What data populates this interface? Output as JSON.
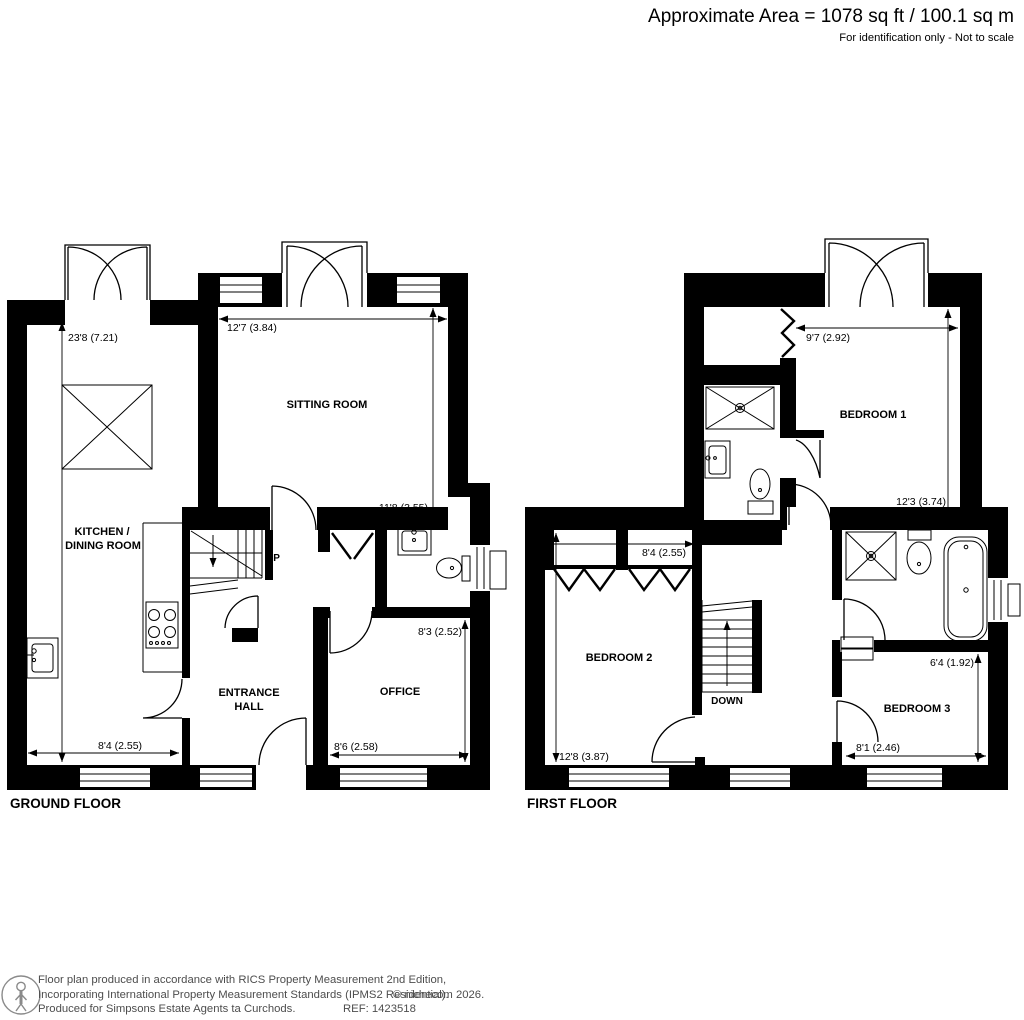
{
  "header": {
    "area_line": "Approximate Area = 1078 sq ft / 100.1 sq m",
    "note_line": "For identification only - Not to scale"
  },
  "ground_floor": {
    "label": "GROUND FLOOR",
    "rooms": {
      "sitting_room": "SITTING ROOM",
      "kitchen_line1": "KITCHEN /",
      "kitchen_line2": "DINING ROOM",
      "hall_line1": "ENTRANCE",
      "hall_line2": "HALL",
      "office": "OFFICE"
    },
    "stairs_label": "UP",
    "dims": {
      "kitchen_length": "23'8 (7.21)",
      "sitting_width": "12'7 (3.84)",
      "sitting_depth": "11'8 (3.55)",
      "kitchen_width": "8'4 (2.55)",
      "office_width": "8'6 (2.58)",
      "office_depth": "8'3 (2.52)"
    }
  },
  "first_floor": {
    "label": "FIRST FLOOR",
    "rooms": {
      "bedroom1": "BEDROOM 1",
      "bedroom2": "BEDROOM 2",
      "bedroom3": "BEDROOM 3"
    },
    "stairs_label": "DOWN",
    "dims": {
      "bedroom1_width": "9'7 (2.92)",
      "bedroom1_depth": "12'3 (3.74)",
      "bedroom2_width": "8'4 (2.55)",
      "bedroom2_depth": "12'8 (3.87)",
      "bedroom3_width": "8'1 (2.46)",
      "bedroom3_depth": "6'4 (1.92)"
    }
  },
  "footer": {
    "line1": "Floor plan produced in accordance with RICS Property Measurement 2nd Edition,",
    "line2": "Incorporating International Property Measurement Standards (IPMS2 Residential).",
    "copyright": "© nichecom 2026.",
    "line3": "Produced for Simpsons Estate Agents ta Curchods.",
    "ref": "REF: 1423518"
  },
  "colors": {
    "ink": "#000000",
    "footer_text": "#4d4d4d"
  }
}
